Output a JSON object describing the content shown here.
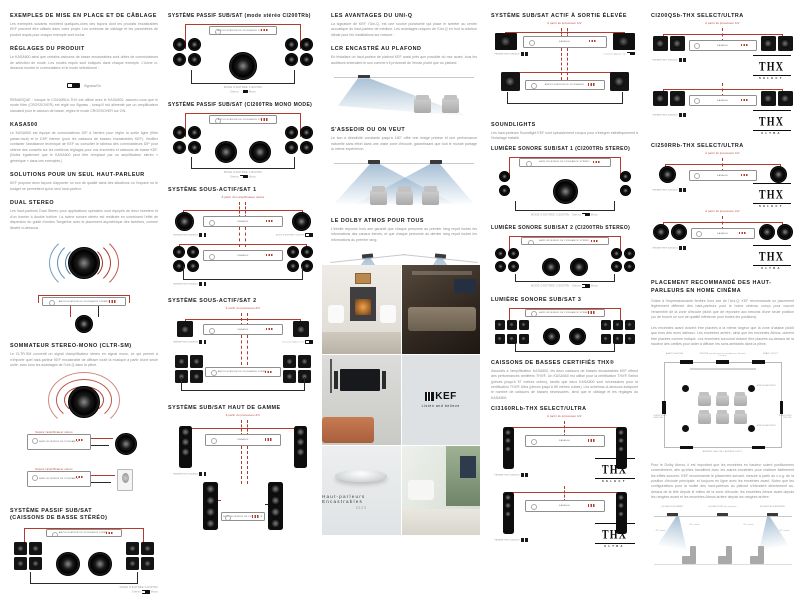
{
  "shared": {
    "stereo_amp": "AMPLIFICATEUR DE PUISSANCE STÉRÉO",
    "power_amp": "AMPLIFICATEUR DE PUISSANCE",
    "kasa": "KASA500",
    "kasa_params": "PARAMÈTRES KASA500",
    "input_mode": "MODE D'ENTRÉE CI200TRb",
    "stereo": "Stereo",
    "mono": "Mono",
    "avp": "À partir du processeur A/V",
    "from_amp": "À partir d'un amplificateur stéréo",
    "crossover": "Crossover Bypass / On",
    "select": "SELECT",
    "ultra": "ULTRA"
  },
  "col1": {
    "s1": {
      "title": "EXEMPLES DE MISE EN PLACE ET DE CÂBLAGE",
      "body": "Les exemples suivants montrent quelques-unes des façons dont les produits encastrables KEF peuvent être utilisés dans votre projet. Les schémas de câblage et les paramètres de produit requis pour chaque exemple sont inclus."
    },
    "s2": {
      "title": "RÉGLAGES DU PRODUIT",
      "body1": "Le KASA500 ainsi que certains caissons de basse encastrables sont dotés de commutateurs de sélection de mode. Les modes requis sont indiqués dans chaque exemple. L'icône ci-dessous montre le commutateur et le mode sélectionné :",
      "switch": "Bypass/On",
      "body2": "REMARQUE : lorsque le CI3160RLb-THX est utilisé avec le KASA500, assurez-vous que le mode filtre (CROSSOVER) est réglé sur Bypass ; lorsqu'il est alimenté par un amplificateur standard pour le caisson de basse, réglez le mode CROSSOVER sur ON."
    },
    "s3": {
      "title": "KASA500",
      "body": "Le KASA500 est équipé de commutateurs DIP à l'arrière pour régler la sortie ligne (filtre passe-haut) et le DSP interne (pour les caissons de basses encastrables KEF). Veuillez contacter l'assistance technique de KEF ou consulter le tableau des commutateurs DIP pour obtenir des conseils sur les meilleurs réglages pour vos enceintes et caissons de basse KEF. (Notez également que le KASA500 peut être remplacé par un amplificateur stéréo « générique » dans ces exemples.)"
    },
    "s4": {
      "title": "SOLUTIONS POUR UN SEUL HAUT-PARLEUR",
      "body": "KEF propose deux façons d'apporter un son de qualité dans des situations où l'espace ou le budget ne permettent qu'un seul haut-parleur."
    },
    "s5": {
      "title": "DUAL STEREO",
      "body": "Les haut-parleurs Dual Stereo pour applications spéciales sont équipés de deux tweeters et d'un bornier à double bobine. La scène sonore stéréo est restituée en combinant l'effet de dispersion du guide d'ondes Tangerine avec le placement asymétrique des tweeters, comme illustré ci-dessous."
    },
    "s6": {
      "title": "SOMMATEUR STEREO-MONO (CLTR-SM)",
      "body": "Le CLTR-SM convertit un signal d'amplificateur stéréo en signal mono, ce qui permet à n'importe quel haut-parleur KEF encastrable de diffuser toute la musique à partir d'une seule unité, avec tous les avantages de l'Uni-Q dans la pièce.",
      "cap1": "Depuis l'amplificateur stéréo",
      "cap2": "Depuis l'amplificateur stéréo"
    },
    "s7": {
      "title1": "SYSTÈME PASSIF SUB/SAT",
      "title2": "(CAISSONS DE BASSE STÉRÉO)"
    }
  },
  "col2": {
    "d1": {
      "title": "SYSTÈME PASSIF SUB/SAT (mode stéréo CI200TRb)"
    },
    "d2": {
      "title": "SYSTÈME PASSIF SUB/SAT (CI200TRb MONO MODE)"
    },
    "d3": {
      "title": "SYSTÈME SOUS-ACTIF/SAT 1"
    },
    "d4": {
      "title": "SYSTÈME SOUS-ACTIF/SAT 2"
    },
    "d5": {
      "title": "SYSTÈME SUB/SAT HAUT DE GAMME"
    }
  },
  "col3": {
    "s1": {
      "title": "LES AVANTAGES DU UNI-Q",
      "body": "La signature de KEF, l'Uni-Q, est une source ponctuelle qui place le tweeter au centre acoustique du haut-parleur de médium. Les avantages uniques de l'Uni-Q en font la solution idéale pour les installations sur mesure :"
    },
    "s2": {
      "title": "LCR ENCASTRÉ AU PLAFOND",
      "body": "En installant un haut-parleur de plafond KEF aussi près que possible du mur avant, tous les auditeurs entendent le son comme s'il provenait de l'écran plutôt que du plafond."
    },
    "s3": {
      "title": "S'ASSEOIR OU ON VEUT",
      "body": "Le son à directivité constante jusqu'à 160° offre une image précise et une performance naturelle sans effort dans une vaste zone d'écoute, garantissant que tout le monde partage la même expérience."
    },
    "s4": {
      "title": "LE DOLBY ATMOS POUR TOUS",
      "body": "L'étroite réponse hors axe garantit que chaque personne au premier rang reçoit toutes les informations des canaux élevés, et que chaque personne au dernier rang reçoit toutes les informations du premier rang."
    }
  },
  "col4": {
    "d1": {
      "title": "SYSTÈME SUB/SAT ACTIF À SORTIE ÉLEVÉE"
    },
    "s2": {
      "title": "SOUNDLIGHTS",
      "body": "Les haut-parleurs Soundlight KEF sont spécialement conçus pour s'intégrer esthétiquement à l'éclairage installé."
    },
    "d2": {
      "title": "LUMIÈRE SONORE SUB/SAT 1 (CI200TRb STEREO)"
    },
    "d3": {
      "title": "LUMIÈRE SONORE SUB/SAT 2 (CI200TRb STEREO)"
    },
    "d4": {
      "title": "LUMIÈRE SONORE SUB/SAT 3"
    },
    "s5": {
      "title": "CAISSONS DE BASSES CERTIFIÉS THX®",
      "body": "Associés à l'amplificateur KASA500, les deux caissons de basses encastrables KEF offrent des performances certifiées THX®. Un KASA500 est utilisé pour la certification THX® Select (pièces jusqu'à 57 mètres cubes), tandis que deux KASA500 sont nécessaires pour la certification THX® Ultra (pièces jusqu'à 85 mètres cubes). Les schémas ci-dessous indiquent le nombre de caissons de basses nécessaires, ainsi que le câblage et les réglages du KASA500."
    },
    "d5": {
      "title": "CI3160RLb-THX SELECT/ULTRA"
    }
  },
  "col5": {
    "d1": {
      "title": "CI200QSb-THX SELECT/ULTRA"
    },
    "d2": {
      "title": "CI250RRb-THX SELECT/ULTRA"
    },
    "s3": {
      "title": "PLACEMENT RECOMMANDÉ DES HAUT-PARLEURS EN HOME CINÉMA",
      "body1": "Grâce à l'impressionnante fenêtre hors axe de l'Uni-Q, KEF recommande un placement légèrement différent des haut-parleurs pour le home cinéma, conçu pour couvrir l'ensemble de la zone d'écoute plutôt que de répondre aux besoins d'une seule position (ou de fournir un son de qualité inférieure pour toutes les positions).",
      "body2": "Les enceintes avant doivent être placées à la même largeur que la zone d'assise plutôt que hors des murs latéraux. Les enceintes arrière, ainsi que les enceintes Atmos, doivent être placées comme indiqué. Les enceintes surround doivent être placées au-dessus de la hauteur des oreilles pour aider à diffuser les sons ambiants dans la pièce.",
      "body3": "Pour le Dolby Atmos, il est important que les enceintes en hauteur soient positionnées correctement, afin qu'elles travaillent avec les autres enceintes pour restituer fidèlement les effets sonores. KEF recommande le placement suivant, mesuré à partir du c.o.g. de la position d'écoute principale, et toujours en ligne avec les enceintes avant. Notez que les configurations pour la moitié des haut-parleurs au plafond s'étendent directement au-dessus de la tête depuis le milieu de la zone d'écoute, les enceintes Atmos avant depuis les rangées avant et les enceintes Atmos arrière depuis les rangées arrière."
    },
    "room": {
      "front_left": "AVANT GAUCHE",
      "centre": "CENTRE (au-dessous ou au-dessus / derrière l'écran)",
      "front_right": "AVANT DROIT",
      "surround_left": "SURROUND GAUCHE",
      "surround_right": "SURROUND DROITE",
      "atmos1": "ATMOS/HAUTEUR",
      "atmos2": "ATMOS/HAUTEUR",
      "rear": "ARRIÈRE GAUCHE / ARRIÈRE DROIT"
    },
    "atmos": {
      "front": "EN HAUTEUR AVANT",
      "mid": "EN HAUTEUR (2e position)",
      "rear": "EN HAUTEUR ARRIÈRE",
      "a1": "45° (max)",
      "a2": "65° (max)",
      "a3": "65° (max)",
      "a4": "45° (max)"
    }
  },
  "cover": {
    "brand": "KEF",
    "tagline": "Listen and believe",
    "title": "Haut-parleurs Encastrables",
    "year": "2023"
  }
}
